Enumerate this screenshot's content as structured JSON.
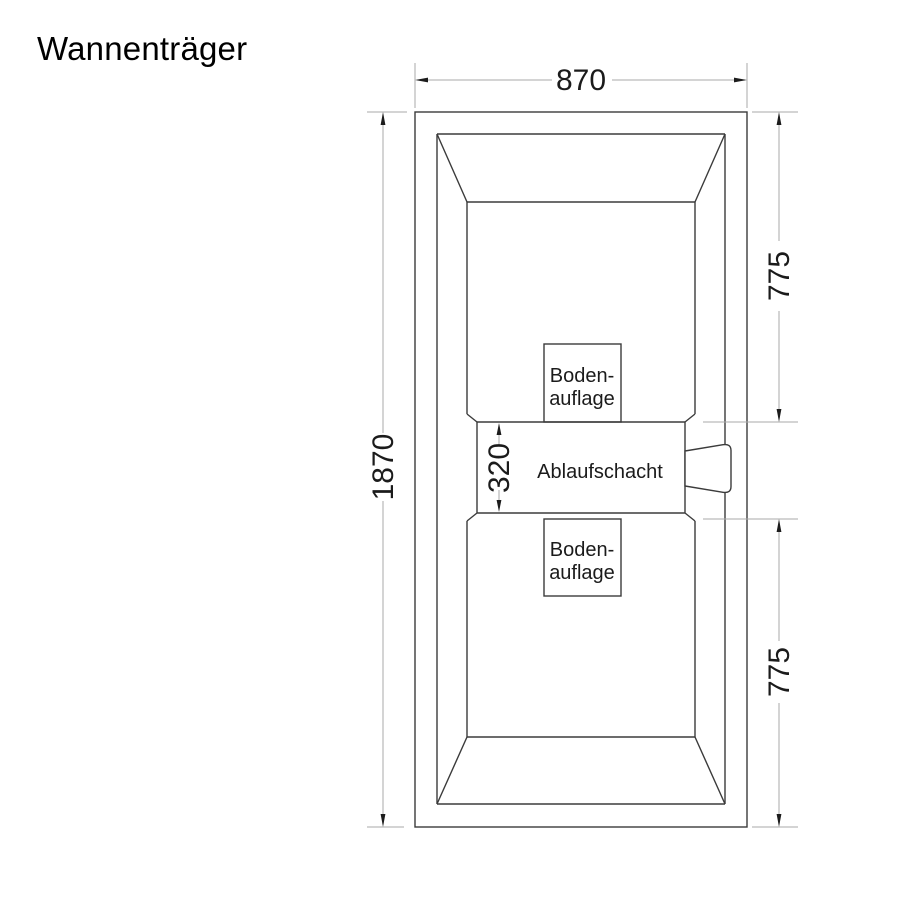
{
  "title": "Wannenträger",
  "colors": {
    "background": "#ffffff",
    "outline": "#3b3b3b",
    "dimension_line": "#aaaaaa",
    "arrow": "#1c1c1c",
    "text": "#1b1b1b"
  },
  "dimensions": {
    "width_top": {
      "value": "870",
      "orientation": "horizontal"
    },
    "height_left": {
      "value": "1870",
      "orientation": "vertical"
    },
    "right_upper": {
      "value": "775",
      "orientation": "vertical"
    },
    "right_lower": {
      "value": "775",
      "orientation": "vertical"
    },
    "drain_channel_height": {
      "value": "320",
      "orientation": "vertical"
    }
  },
  "labels": {
    "floor_support_top": {
      "line1": "Boden-",
      "line2": "auflage"
    },
    "floor_support_bottom": {
      "line1": "Boden-",
      "line2": "auflage"
    },
    "drain_channel": "Ablaufschacht"
  }
}
